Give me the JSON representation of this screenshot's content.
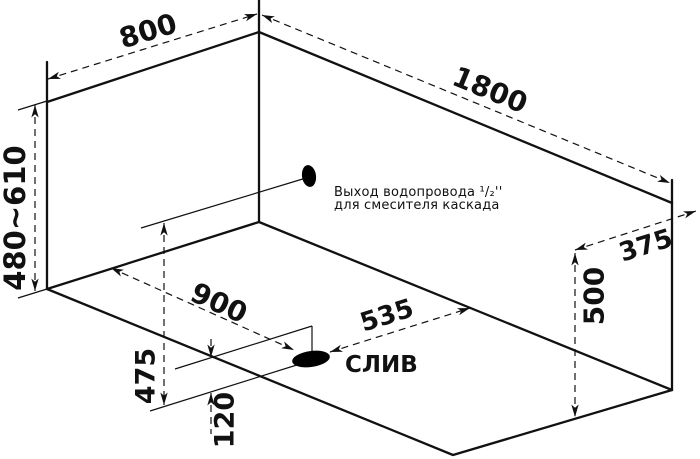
{
  "drawing": {
    "background": "#ffffff",
    "line_color": "#111111",
    "dimensions": {
      "top_width": "800",
      "top_length": "1800",
      "left_height": "480~610",
      "right_offset": "375",
      "right_height": "500",
      "drain_along_length": "900",
      "drain_along_width": "535",
      "drain_front_offset": "475",
      "drain_small_offset": "120"
    },
    "annotations": {
      "drain_label": "СЛИВ",
      "outlet_note_line1": "Выход водопровода ¹/₂''",
      "outlet_note_line2": "для смесителя каскада"
    }
  }
}
